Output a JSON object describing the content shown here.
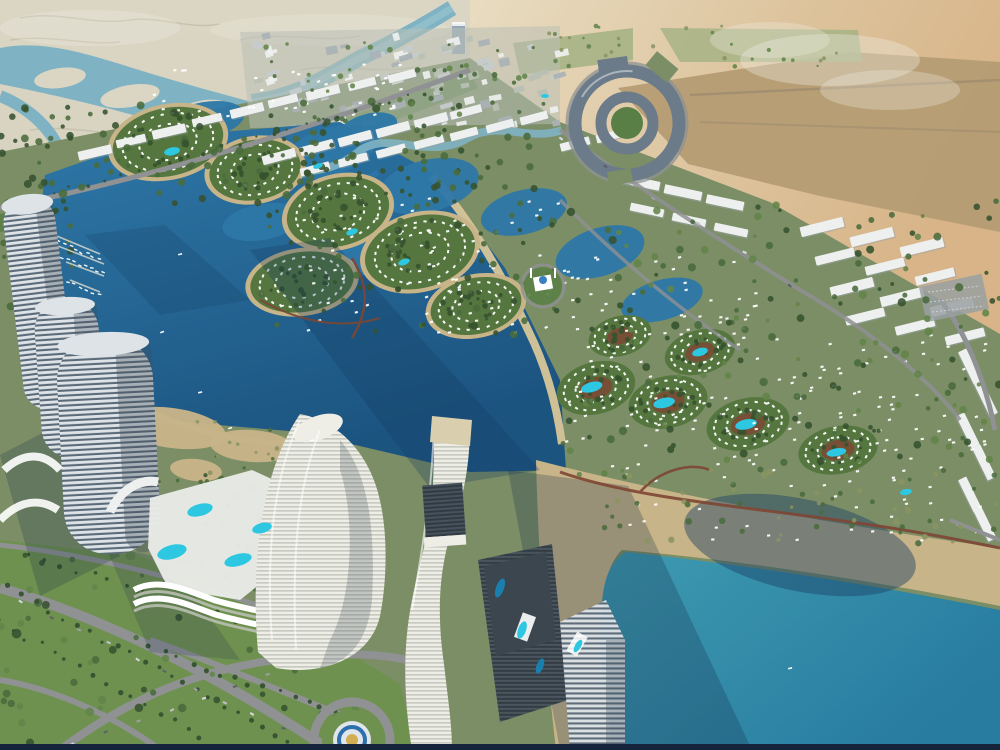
{
  "scene": {
    "name": "coastal-masterplan-aerial-render",
    "kind": "architectural aerial rendering",
    "features": "desert flats with tidal channels, marina lagoon with crescent villa islands, white row housing, circular hub complex, striped curved towers with pool podiums, teal swimming lagoon with beach boardwalk, roundabout fountain"
  },
  "colors": {
    "flats_light": "#dbd6c4",
    "flats": "#ccc8b1",
    "squiggle": "#b8b49c",
    "channel": "#7fb3c3",
    "channel_light": "#9cc4d0",
    "desert_light": "#e8dcc1",
    "desert_warm": "#dcc29b",
    "desert_orange": "#d8b488",
    "desert_brown": "#b59c73",
    "desert_road": "#9a8a6e",
    "field_green": "#a3b183",
    "haze": "#f2efe6",
    "coast_green": "#5a7f46",
    "dev_green": "#7c8e66",
    "lawn_green": "#6f9150",
    "island_green": "#55763f",
    "tree_dark": "#35522f",
    "tree_mid": "#4a6b3c",
    "tree_light": "#628449",
    "olive": "#8a9462",
    "lagoon_top": "#2e78a8",
    "lagoon_deep": "#1c5480",
    "lagoon_shadow": "#12395c",
    "teal_light": "#3e9ab0",
    "teal_deep": "#277ca0",
    "teal_shadow": "#1c4067",
    "shadow_navy": "#14294a",
    "beach": "#c7b488",
    "beach_light": "#d8c698",
    "bld_white": "#eef0ef",
    "bld_shadow": "#9aa3a8",
    "bld_gray": "#c6cccd",
    "bld_gray2": "#aab2b6",
    "bld_green": "#b9c0b4",
    "tower_light": "#dde3e7",
    "tower_dark": "#5c6b7a",
    "tower_mid": "#6b7b89",
    "tower_edge": "#3f4c59",
    "cream_light": "#efeee6",
    "cream_dark": "#c3c6bd",
    "roof_beige": "#d9cfae",
    "dark2a": "#48525c",
    "dark2b": "#2f3942",
    "deck_dark": "#3c464f",
    "road": "#8f9193",
    "road_dark": "#717476",
    "parking": "#9aa0a2",
    "boardwalk": "#7e4634",
    "accent_orange": "#c8643c",
    "pool": "#2ec7e2",
    "pool_deep": "#1b7fae",
    "fountain_blue": "#2c6fad",
    "fountain_gold": "#d2ae52",
    "fountain_deck": "#dfe5ea",
    "mosque_blue": "#3a7fc2",
    "distant_tower": "#93a7b8",
    "pier": "#c9cfc9",
    "navy_bar": "#16243c",
    "white": "#ffffff"
  },
  "decor": {
    "city_blocks": {
      "x": 245,
      "y": 34,
      "w": 318,
      "h": 92,
      "n": 85,
      "seed": 89
    },
    "building_bars": [
      [
        78,
        148,
        34,
        9,
        -13
      ],
      [
        116,
        137,
        30,
        8,
        -13
      ],
      [
        152,
        127,
        34,
        9,
        -13
      ],
      [
        192,
        116,
        30,
        8,
        -13
      ],
      [
        230,
        106,
        34,
        9,
        -14
      ],
      [
        268,
        97,
        30,
        8,
        -14
      ],
      [
        306,
        88,
        34,
        9,
        -14
      ],
      [
        348,
        80,
        28,
        8,
        -14
      ],
      [
        388,
        72,
        28,
        8,
        -14
      ],
      [
        262,
        152,
        34,
        9,
        -15
      ],
      [
        300,
        143,
        34,
        9,
        -15
      ],
      [
        338,
        134,
        34,
        9,
        -15
      ],
      [
        376,
        125,
        34,
        9,
        -15
      ],
      [
        414,
        116,
        34,
        9,
        -15
      ],
      [
        450,
        108,
        32,
        8,
        -15
      ],
      [
        300,
        165,
        30,
        8,
        -15
      ],
      [
        338,
        156,
        30,
        8,
        -15
      ],
      [
        376,
        147,
        30,
        8,
        -15
      ],
      [
        414,
        138,
        30,
        8,
        -15
      ],
      [
        450,
        130,
        28,
        8,
        -15
      ],
      [
        486,
        122,
        28,
        8,
        -15
      ],
      [
        622,
        178,
        38,
        9,
        12
      ],
      [
        664,
        188,
        38,
        9,
        12
      ],
      [
        706,
        198,
        38,
        9,
        12
      ],
      [
        630,
        206,
        34,
        8,
        12
      ],
      [
        672,
        216,
        34,
        8,
        12
      ],
      [
        714,
        226,
        34,
        8,
        12
      ],
      [
        800,
        222,
        44,
        10,
        -14
      ],
      [
        850,
        232,
        44,
        10,
        -14
      ],
      [
        900,
        242,
        44,
        10,
        -14
      ],
      [
        815,
        252,
        40,
        9,
        -14
      ],
      [
        865,
        262,
        40,
        9,
        -14
      ],
      [
        915,
        272,
        40,
        9,
        -14
      ],
      [
        830,
        282,
        44,
        10,
        -14
      ],
      [
        880,
        292,
        44,
        10,
        -14
      ],
      [
        930,
        302,
        44,
        10,
        -14
      ],
      [
        845,
        312,
        40,
        9,
        -14
      ],
      [
        895,
        322,
        40,
        9,
        -14
      ],
      [
        945,
        332,
        40,
        9,
        -14
      ],
      [
        952,
        362,
        36,
        9,
        64
      ],
      [
        968,
        394,
        36,
        9,
        64
      ],
      [
        950,
        426,
        36,
        9,
        64
      ],
      [
        966,
        458,
        36,
        9,
        64
      ],
      [
        952,
        490,
        36,
        9,
        64
      ],
      [
        968,
        520,
        34,
        9,
        64
      ],
      [
        560,
        140,
        30,
        8,
        -15
      ],
      [
        596,
        132,
        28,
        8,
        -15
      ],
      [
        520,
        114,
        28,
        8,
        -15
      ]
    ],
    "islands": [
      {
        "cx": 168,
        "cy": 142,
        "rx": 56,
        "ry": 34,
        "rot": -12,
        "seed": 3,
        "pool": [
          2,
          10,
          8,
          4
        ]
      },
      {
        "cx": 255,
        "cy": 170,
        "rx": 46,
        "ry": 30,
        "rot": -10,
        "seed": 5
      },
      {
        "cx": 338,
        "cy": 212,
        "rx": 52,
        "ry": 34,
        "rot": -14,
        "seed": 7
      },
      {
        "cx": 420,
        "cy": 252,
        "rx": 56,
        "ry": 36,
        "rot": -14,
        "seed": 9
      },
      {
        "cx": 302,
        "cy": 282,
        "rx": 52,
        "ry": 30,
        "rot": -8,
        "seed": 11
      },
      {
        "cx": 476,
        "cy": 306,
        "rx": 46,
        "ry": 28,
        "rot": -12,
        "seed": 13
      }
    ],
    "clusters": [
      {
        "cx": 596,
        "cy": 388,
        "rx": 40,
        "ry": 26,
        "rot": -15,
        "seed": 15,
        "pool": [
          -4,
          -2,
          11,
          5
        ]
      },
      {
        "cx": 668,
        "cy": 402,
        "rx": 40,
        "ry": 26,
        "rot": -12,
        "seed": 17,
        "pool": [
          -4,
          0,
          11,
          5
        ]
      },
      {
        "cx": 748,
        "cy": 424,
        "rx": 42,
        "ry": 26,
        "rot": -12,
        "seed": 19,
        "pool": [
          -2,
          0,
          11,
          5
        ]
      },
      {
        "cx": 838,
        "cy": 450,
        "rx": 40,
        "ry": 24,
        "rot": -10,
        "seed": 21,
        "pool": [
          -2,
          2,
          10,
          4
        ]
      },
      {
        "cx": 700,
        "cy": 352,
        "rx": 36,
        "ry": 22,
        "rot": -15,
        "seed": 23,
        "pool": [
          0,
          0,
          8,
          4
        ]
      },
      {
        "cx": 620,
        "cy": 336,
        "rx": 32,
        "ry": 20,
        "rot": -15,
        "seed": 25
      }
    ],
    "villa_zones": [
      {
        "x": 300,
        "y": 195,
        "w": 260,
        "h": 140,
        "n": 70,
        "seed": 27,
        "rot": -15
      },
      {
        "x": 560,
        "y": 330,
        "w": 430,
        "h": 145,
        "n": 130,
        "seed": 29,
        "rot": -12
      },
      {
        "x": 560,
        "y": 255,
        "w": 200,
        "h": 75,
        "n": 40,
        "seed": 31,
        "rot": -12
      },
      {
        "x": 150,
        "y": 62,
        "w": 250,
        "h": 55,
        "n": 40,
        "seed": 33,
        "rot": -13
      },
      {
        "x": 620,
        "y": 470,
        "w": 360,
        "h": 70,
        "n": 36,
        "seed": 35,
        "rot": -8
      }
    ],
    "tree_zones": [
      {
        "x": 0,
        "y": 100,
        "w": 460,
        "h": 112,
        "n": 110,
        "rmin": 1.8,
        "rmax": 4.2,
        "seed": 7,
        "colors": [
          "tree_dark",
          "tree_mid"
        ]
      },
      {
        "x": 0,
        "y": 182,
        "w": 72,
        "h": 150,
        "n": 45,
        "rmin": 2,
        "rmax": 4.5,
        "seed": 11,
        "colors": [
          "tree_dark",
          "tree_mid"
        ]
      },
      {
        "x": 250,
        "y": 40,
        "w": 310,
        "h": 85,
        "n": 45,
        "rmin": 1.4,
        "rmax": 3,
        "seed": 13,
        "colors": [
          "tree_mid",
          "tree_light"
        ]
      },
      {
        "x": 260,
        "y": 130,
        "w": 300,
        "h": 205,
        "n": 115,
        "rmin": 1.8,
        "rmax": 3.8,
        "seed": 17,
        "colors": [
          "tree_dark",
          "tree_mid"
        ]
      },
      {
        "x": 560,
        "y": 200,
        "w": 440,
        "h": 275,
        "n": 170,
        "rmin": 1.8,
        "rmax": 4.2,
        "seed": 19,
        "colors": [
          "tree_mid",
          "tree_dark",
          "tree_light"
        ]
      },
      {
        "x": 0,
        "y": 545,
        "w": 360,
        "h": 200,
        "n": 70,
        "rmin": 2.5,
        "rmax": 5,
        "seed": 23,
        "colors": [
          "tree_mid",
          "tree_dark",
          "tree_light"
        ]
      },
      {
        "x": 600,
        "y": 468,
        "w": 400,
        "h": 78,
        "n": 60,
        "rmin": 1.6,
        "rmax": 3.4,
        "seed": 29,
        "colors": [
          "olive",
          "tree_mid"
        ]
      },
      {
        "x": 545,
        "y": 25,
        "w": 300,
        "h": 42,
        "n": 30,
        "rmin": 1.2,
        "rmax": 2.4,
        "seed": 31,
        "colors": [
          "olive",
          "tree_light"
        ]
      },
      {
        "x": 140,
        "y": 470,
        "w": 150,
        "h": 115,
        "n": 25,
        "rmin": 1.8,
        "rmax": 3.4,
        "seed": 37,
        "colors": [
          "tree_mid",
          "tree_dark"
        ]
      },
      {
        "x": 150,
        "y": 418,
        "w": 140,
        "h": 66,
        "n": 25,
        "rmin": 1.2,
        "rmax": 2.4,
        "seed": 41,
        "colors": [
          "olive",
          "tree_mid"
        ]
      }
    ],
    "lines": [
      {
        "x1": 10,
        "y1": 588,
        "x2": 290,
        "y2": 742,
        "n": 22,
        "style": "palm",
        "seed": 43,
        "j": 6
      },
      {
        "x1": 0,
        "y1": 622,
        "x2": 200,
        "y2": 736,
        "n": 16,
        "style": "palm",
        "seed": 47,
        "j": 6
      },
      {
        "x1": 150,
        "y1": 648,
        "x2": 350,
        "y2": 718,
        "n": 15,
        "style": "palm",
        "seed": 49,
        "j": 6
      },
      {
        "x1": 30,
        "y1": 556,
        "x2": 330,
        "y2": 648,
        "n": 20,
        "style": "palm",
        "seed": 53,
        "j": 6
      },
      {
        "x1": 20,
        "y1": 202,
        "x2": 440,
        "y2": 88,
        "n": 26,
        "style": "palm_s",
        "seed": 59,
        "j": 5
      },
      {
        "x1": 20,
        "y1": 600,
        "x2": 280,
        "y2": 728,
        "n": 10,
        "style": "car",
        "seed": 61,
        "j": 4
      },
      {
        "x1": 70,
        "y1": 744,
        "x2": 300,
        "y2": 662,
        "n": 8,
        "style": "car",
        "seed": 67,
        "j": 4
      },
      {
        "x1": 560,
        "y1": 136,
        "x2": 790,
        "y2": 282,
        "n": 6,
        "style": "car",
        "seed": 71,
        "j": 5
      },
      {
        "x1": 52,
        "y1": 238,
        "x2": 98,
        "y2": 258,
        "n": 9,
        "style": "boat",
        "seed": 73,
        "j": 3
      },
      {
        "x1": 60,
        "y1": 256,
        "x2": 102,
        "y2": 272,
        "n": 8,
        "style": "boat",
        "seed": 79,
        "j": 3
      },
      {
        "x1": 66,
        "y1": 280,
        "x2": 98,
        "y2": 294,
        "n": 6,
        "style": "boat",
        "seed": 83,
        "j": 3
      }
    ],
    "pools": [
      [
        352,
        232,
        6,
        3,
        -20,
        "pool"
      ],
      [
        404,
        262,
        6,
        3,
        -20,
        "pool"
      ],
      [
        318,
        166,
        5,
        2.5,
        -20,
        "pool"
      ],
      [
        545,
        96,
        4,
        2,
        0,
        "pool"
      ],
      [
        906,
        492,
        6,
        3,
        -10,
        "pool"
      ],
      [
        200,
        510,
        13,
        6,
        -15,
        "pool"
      ],
      [
        172,
        552,
        15,
        7,
        -15,
        "pool"
      ],
      [
        238,
        560,
        14,
        6,
        -15,
        "pool"
      ],
      [
        262,
        528,
        10,
        5,
        -15,
        "pool"
      ],
      [
        500,
        588,
        10,
        4,
        -70,
        "pool_deep"
      ],
      [
        522,
        630,
        9,
        4,
        -70,
        "pool"
      ],
      [
        540,
        666,
        8,
        3.5,
        -70,
        "pool_deep"
      ],
      [
        578,
        646,
        7,
        3,
        -60,
        "pool"
      ]
    ],
    "boats": [
      [
        160,
        332,
        -20
      ],
      [
        178,
        254,
        -15
      ],
      [
        198,
        392,
        -12
      ],
      [
        228,
        428,
        -18
      ],
      [
        280,
        306,
        -20
      ],
      [
        788,
        668,
        -14
      ],
      [
        310,
        440,
        -10
      ]
    ]
  }
}
